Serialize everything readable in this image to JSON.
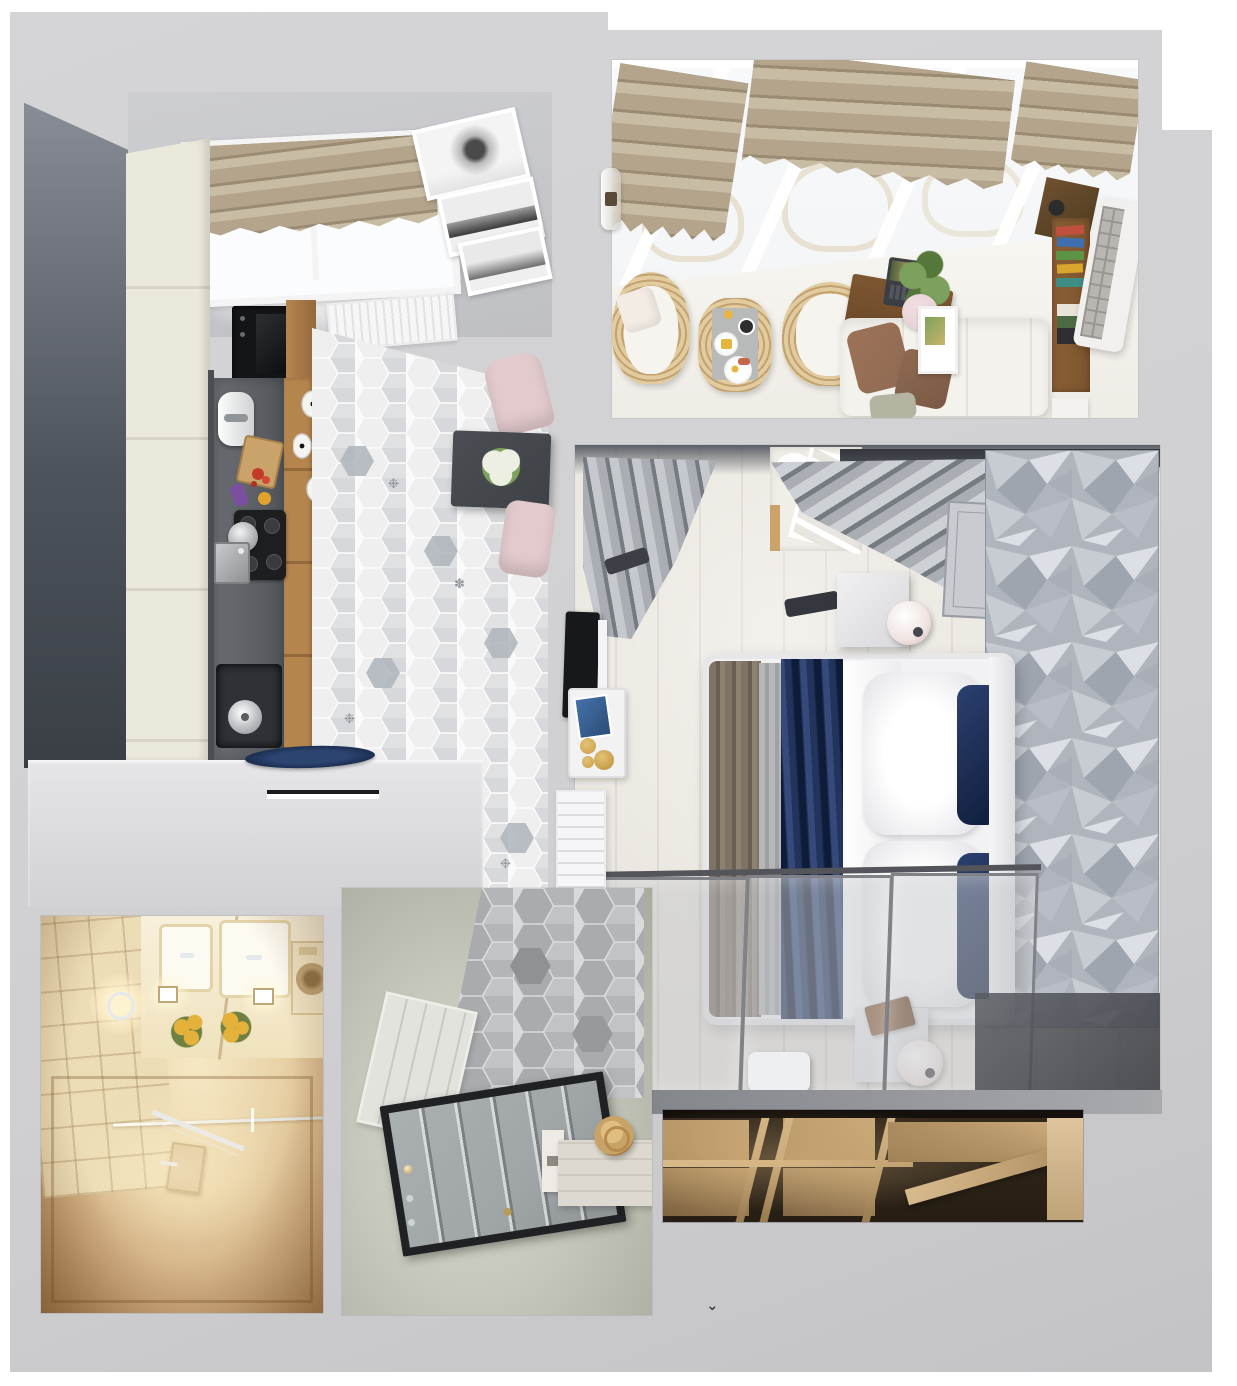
{
  "title": "Top-down 3D render of a one-bedroom apartment floor plan",
  "artifact": {
    "glyph": "⌄"
  },
  "palette": {
    "outer": "#ffffff",
    "slab": "#d5d5d7",
    "slabEdge": "#c3c3c6",
    "wallDark": "#4e545c",
    "wallDarkTop": "#8a8e96",
    "wallLight": "#c9cacd",
    "cream": "#ebe8dc",
    "creamSeam": "#d8d4c6",
    "counter": "#63676c",
    "counterDark": "#3f4347",
    "wood": "#b5854e",
    "woodDark": "#93693c",
    "frameWhite": "#f4f4f5",
    "shadeTan": "#b3a48b",
    "shadeStripe": "#9a8b72",
    "shadeLight": "#c9bca4",
    "picPaper": "#f1f1f1",
    "picInk": "#4a4a4a",
    "radiator": "#f6f6f7",
    "grout": "#fafafa",
    "hex1": "#efeff0",
    "hex2": "#e0e1e3",
    "hex3": "#cfd1d4",
    "hexAccent": "#afb5bc",
    "tableDark": "#3e4246",
    "flowers": "#ecefe2",
    "chairPink": "#e3cacd",
    "glassSky": "#f3f5f7",
    "wicker": "#e1cb9f",
    "wickerDeep": "#c2a270",
    "cushionWhite": "#f6f4ef",
    "trayGray": "#b7bab9",
    "cupBlack": "#2e2e2e",
    "foodYellow": "#e6b53e",
    "deskWood": "#6e4b2a",
    "laptopDark": "#3b3e42",
    "plantGreen": "#7ba15c",
    "plantDeep": "#55773b",
    "sofaWhite": "#f4f2ec",
    "pillowBrown": "#8f6a53",
    "pillowSage": "#b5b3a2",
    "pillowPink": "#e8d2d6",
    "shelfWood": "#7d552e",
    "acWhite": "#f1f0ee",
    "acGrille": "#9a9792",
    "bookRed": "#c0503e",
    "bookBlue": "#3f6fae",
    "bookGreen": "#5d9344",
    "bookYellow": "#d9a62e",
    "bookTeal": "#3e8e85",
    "bfloor": "#e9e5dd",
    "bplank": "#d9d3c9",
    "bDark": "#43464d",
    "curtain": "#aaadb3",
    "curtainDeep": "#767a81",
    "panelGray": "#c9cbd1",
    "panelLine": "#989ca4",
    "bedWhite": "#f2f2f4",
    "navy": "#22345c",
    "navyDeep": "#0f1c39",
    "taupe": "#7f7366",
    "grayBlanket": "#b6b7b9",
    "lampShade": "#f0e4e1",
    "tvBlack": "#17181b",
    "gold": "#c79f49",
    "dresserWhite": "#eaeaec",
    "slideFrame": "#808288",
    "slideGlass": "rgba(196,197,201,0.5)",
    "track": "#53555a",
    "facetA": "#c7cbd2",
    "facetB": "#b0b5bd",
    "facetC": "#dcdfe5",
    "facetD": "#9fa5ae",
    "bathGlow": "#f7e9c6",
    "bathMid": "#e9d3a8",
    "bathDeep": "#a37c4f",
    "bathFloor": "#c79f6c",
    "bathWhite": "#f7f0dc",
    "flowerYellow": "#e4b23a",
    "leafGreen": "#6f8040",
    "chrome": "#e6e9ec",
    "sage": "#c5c8bb",
    "sageDeep": "#a8ab9d",
    "hallHexA": "#a9abae",
    "hallHexB": "#c1c3c6",
    "wainscot": "#e2e3dd",
    "doorBlack": "#202124",
    "doorLeaf": "#a0a5a7",
    "consoleWhite": "#eeebe4",
    "hatTan": "#c8a367",
    "wrDark": "#261e14",
    "wrShelf": "#d3b487",
    "wrMid": "#a8875a",
    "wrBack": "#e0c79f",
    "benchWhite": "#edeff0"
  },
  "rooms": {
    "kitchen": {
      "label": "Kitchen and dining",
      "items": [
        "window with linen roman shade",
        "gallery of three winter photographs",
        "panel radiator",
        "cream cabinet run",
        "built-in oven stack",
        "oak cabinet strip",
        "dark stone countertop",
        "coffee machine",
        "cutting board",
        "vegetables",
        "gas hob with pot",
        "steel sink",
        "waste bin with pot",
        "black chandelier with white shades",
        "hexagonal patterned tile floor",
        "dark dining table with white bouquet",
        "two blush dining chairs",
        "white peninsula with navy serving plate",
        "recessed door pull"
      ]
    },
    "balcony": {
      "label": "Glazed balcony lounge",
      "items": [
        "glass roof with white mullions",
        "three linen roman shades",
        "glass wall sconce",
        "two rattan armchairs",
        "rattan coffee table with breakfast tray",
        "dark wood writing desk",
        "open laptop",
        "potted plant",
        "white lounge sofa",
        "terracotta and sage cushions",
        "gallery frame",
        "walnut bookshelf with books",
        "air-conditioner unit"
      ]
    },
    "bedroom": {
      "label": "Bedroom",
      "items": [
        "gray blackout curtains",
        "white cot in wall niche",
        "draped curtain swag",
        "molded headboard panel",
        "silver 3D-textured accent wall",
        "double bed with white duvet",
        "navy satin throw",
        "taupe blanket",
        "white pillows with navy cushions",
        "two white nightstands",
        "globe table lamps",
        "wall-mounted TV",
        "brass decor tray",
        "white wall radiator",
        "chest of drawers",
        "three-panel glass sliding wardrobe",
        "dressing bench"
      ]
    },
    "bathroom": {
      "label": "Bathroom",
      "items": [
        "beveled cream wall tiles",
        "double vanity with mirror",
        "yellow flower bouquet",
        "chrome sconce",
        "washing machine",
        "recessed spotlights",
        "glass shower screen",
        "chrome towel bar",
        "shower mixer panel",
        "beige mosaic floor"
      ]
    },
    "hallway": {
      "label": "Entry hall",
      "items": [
        "gray hexagonal tile floor",
        "white wainscot panelling",
        "charcoal-framed entry door",
        "chrome door hardware",
        "white console cabinet",
        "straw hat"
      ]
    },
    "wardrobe": {
      "label": "Walk-in wardrobe cutaway",
      "items": [
        "tan shelving compartments",
        "angled shelf board",
        "warm interior lighting"
      ]
    }
  }
}
